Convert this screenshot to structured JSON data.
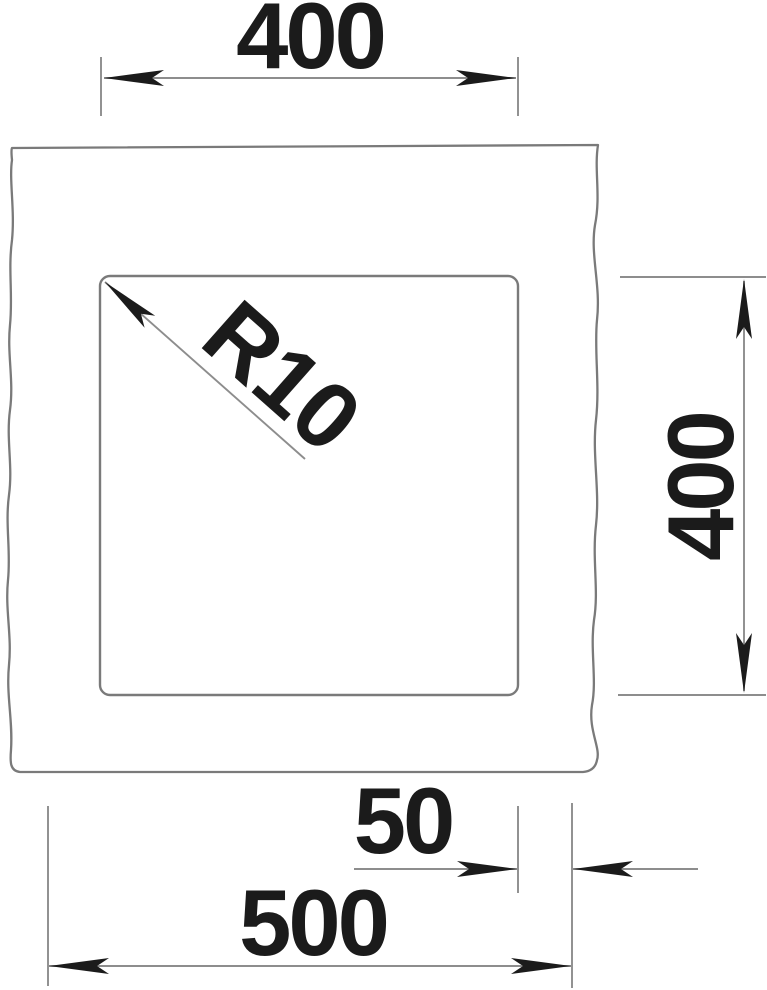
{
  "drawing": {
    "kind": "sink-cutout-dimension-drawing",
    "dimensions": {
      "bowl_width": "400",
      "bowl_depth": "400",
      "edge_offset": "50",
      "overall_width": "500",
      "corner_radius": "R10"
    },
    "colors": {
      "background": "#ffffff",
      "outline": "#7a7a7a",
      "dimension_line": "#8d8d8d",
      "ink": "#1b1b1b"
    }
  }
}
